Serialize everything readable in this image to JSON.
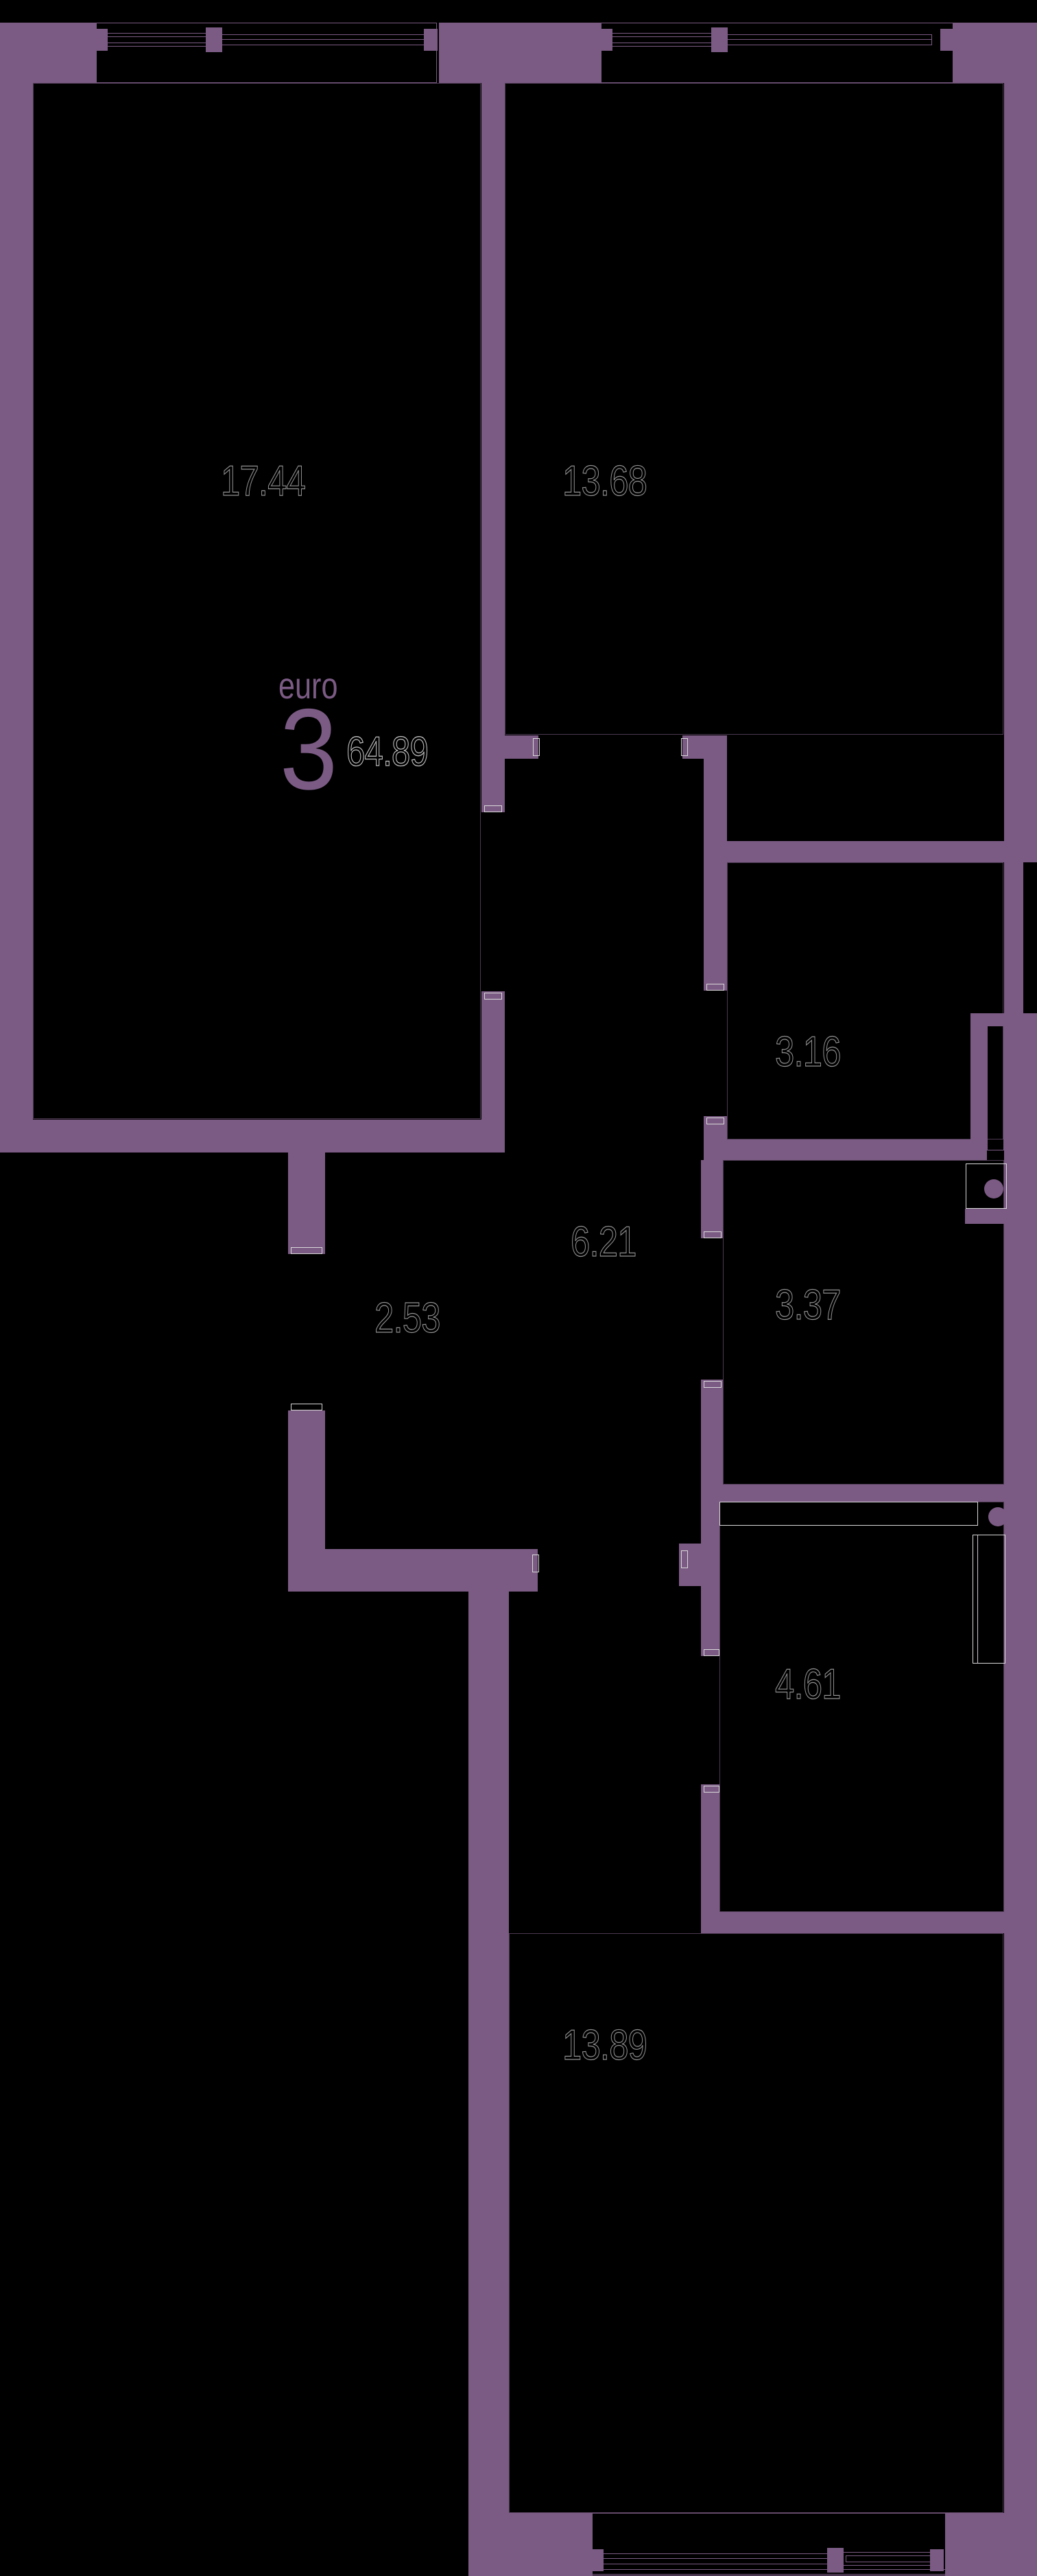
{
  "plan": {
    "type_label": "euro",
    "rooms_count": "3",
    "total_area": "64.89",
    "room_areas": [
      "17.44",
      "13.68",
      "3.16",
      "6.21",
      "3.37",
      "2.53",
      "4.61",
      "13.89"
    ],
    "colors": {
      "wall": "#7b5b84",
      "background": "#000000",
      "area_label_outline": "#929292",
      "total_area_outline": "#bdbdbd",
      "door_frame": "#d9d9d9"
    }
  }
}
